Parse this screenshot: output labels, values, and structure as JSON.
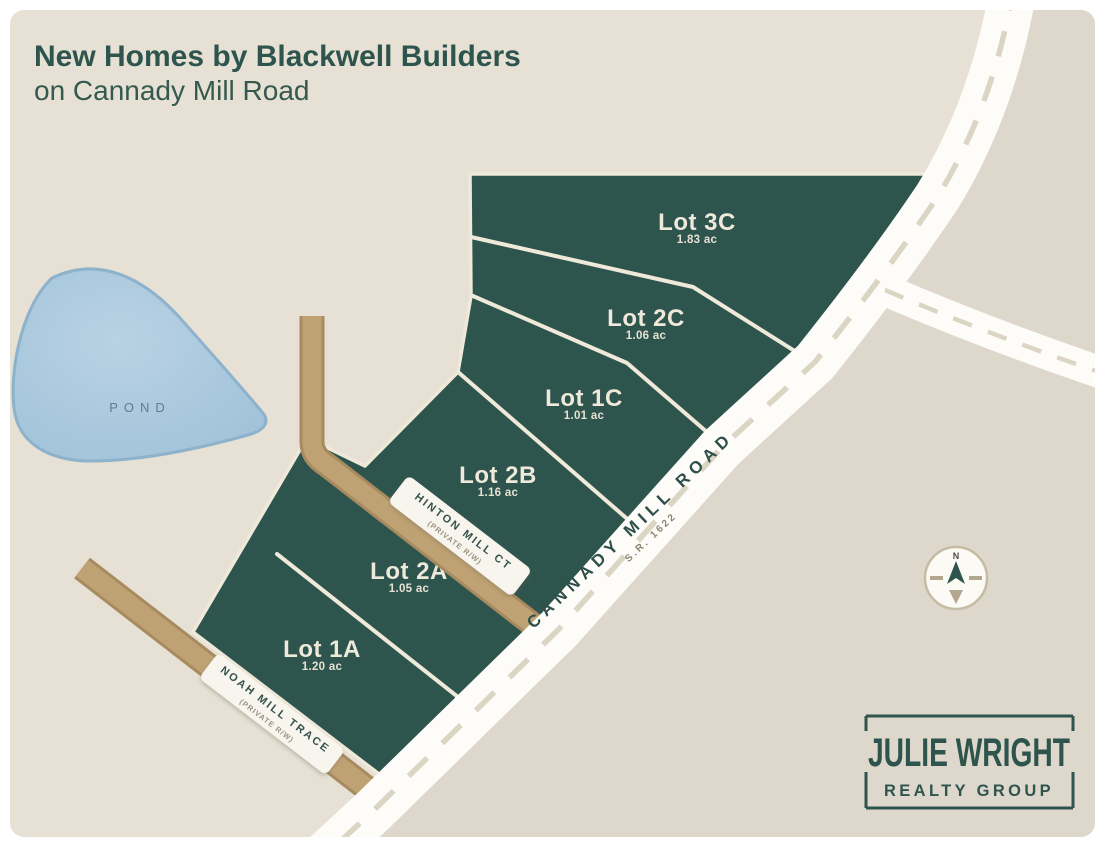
{
  "title": {
    "line1": "New Homes by Blackwell Builders",
    "line2": "on Cannady Mill Road"
  },
  "lots": [
    {
      "name": "Lot 3C",
      "acreage": "1.83 ac"
    },
    {
      "name": "Lot 2C",
      "acreage": "1.06 ac"
    },
    {
      "name": "Lot 1C",
      "acreage": "1.01 ac"
    },
    {
      "name": "Lot 2B",
      "acreage": "1.16 ac"
    },
    {
      "name": "Lot 2A",
      "acreage": "1.05 ac"
    },
    {
      "name": "Lot 1A",
      "acreage": "1.20 ac"
    }
  ],
  "roads": {
    "cannady": {
      "name": "CANNADY MILL ROAD",
      "route": "S.R. 1622"
    },
    "hinton": {
      "name": "HINTON MILL CT",
      "note": "(PRIVATE R/W)"
    },
    "noah": {
      "name": "NOAH MILL TRACE",
      "note": "(PRIVATE R/W)"
    }
  },
  "pond": {
    "label": "POND"
  },
  "compass": {
    "north": "N"
  },
  "logo": {
    "name": "JULIE WRIGHT",
    "tagline": "REALTY GROUP"
  },
  "colors": {
    "parcel": "#2e544e",
    "map_bg": "#e6e1d4",
    "map_bg_east": "#ddd8cb",
    "road_white": "#fdfcf8",
    "road_tan": "#bfa273",
    "road_tan_edge": "#a78b5f",
    "boundary_cream": "#efe9da",
    "pond_fill": "#a9c8de",
    "pond_edge": "#8db2cb",
    "text_teal": "#2e544e",
    "dash": "#dbd5c4"
  }
}
